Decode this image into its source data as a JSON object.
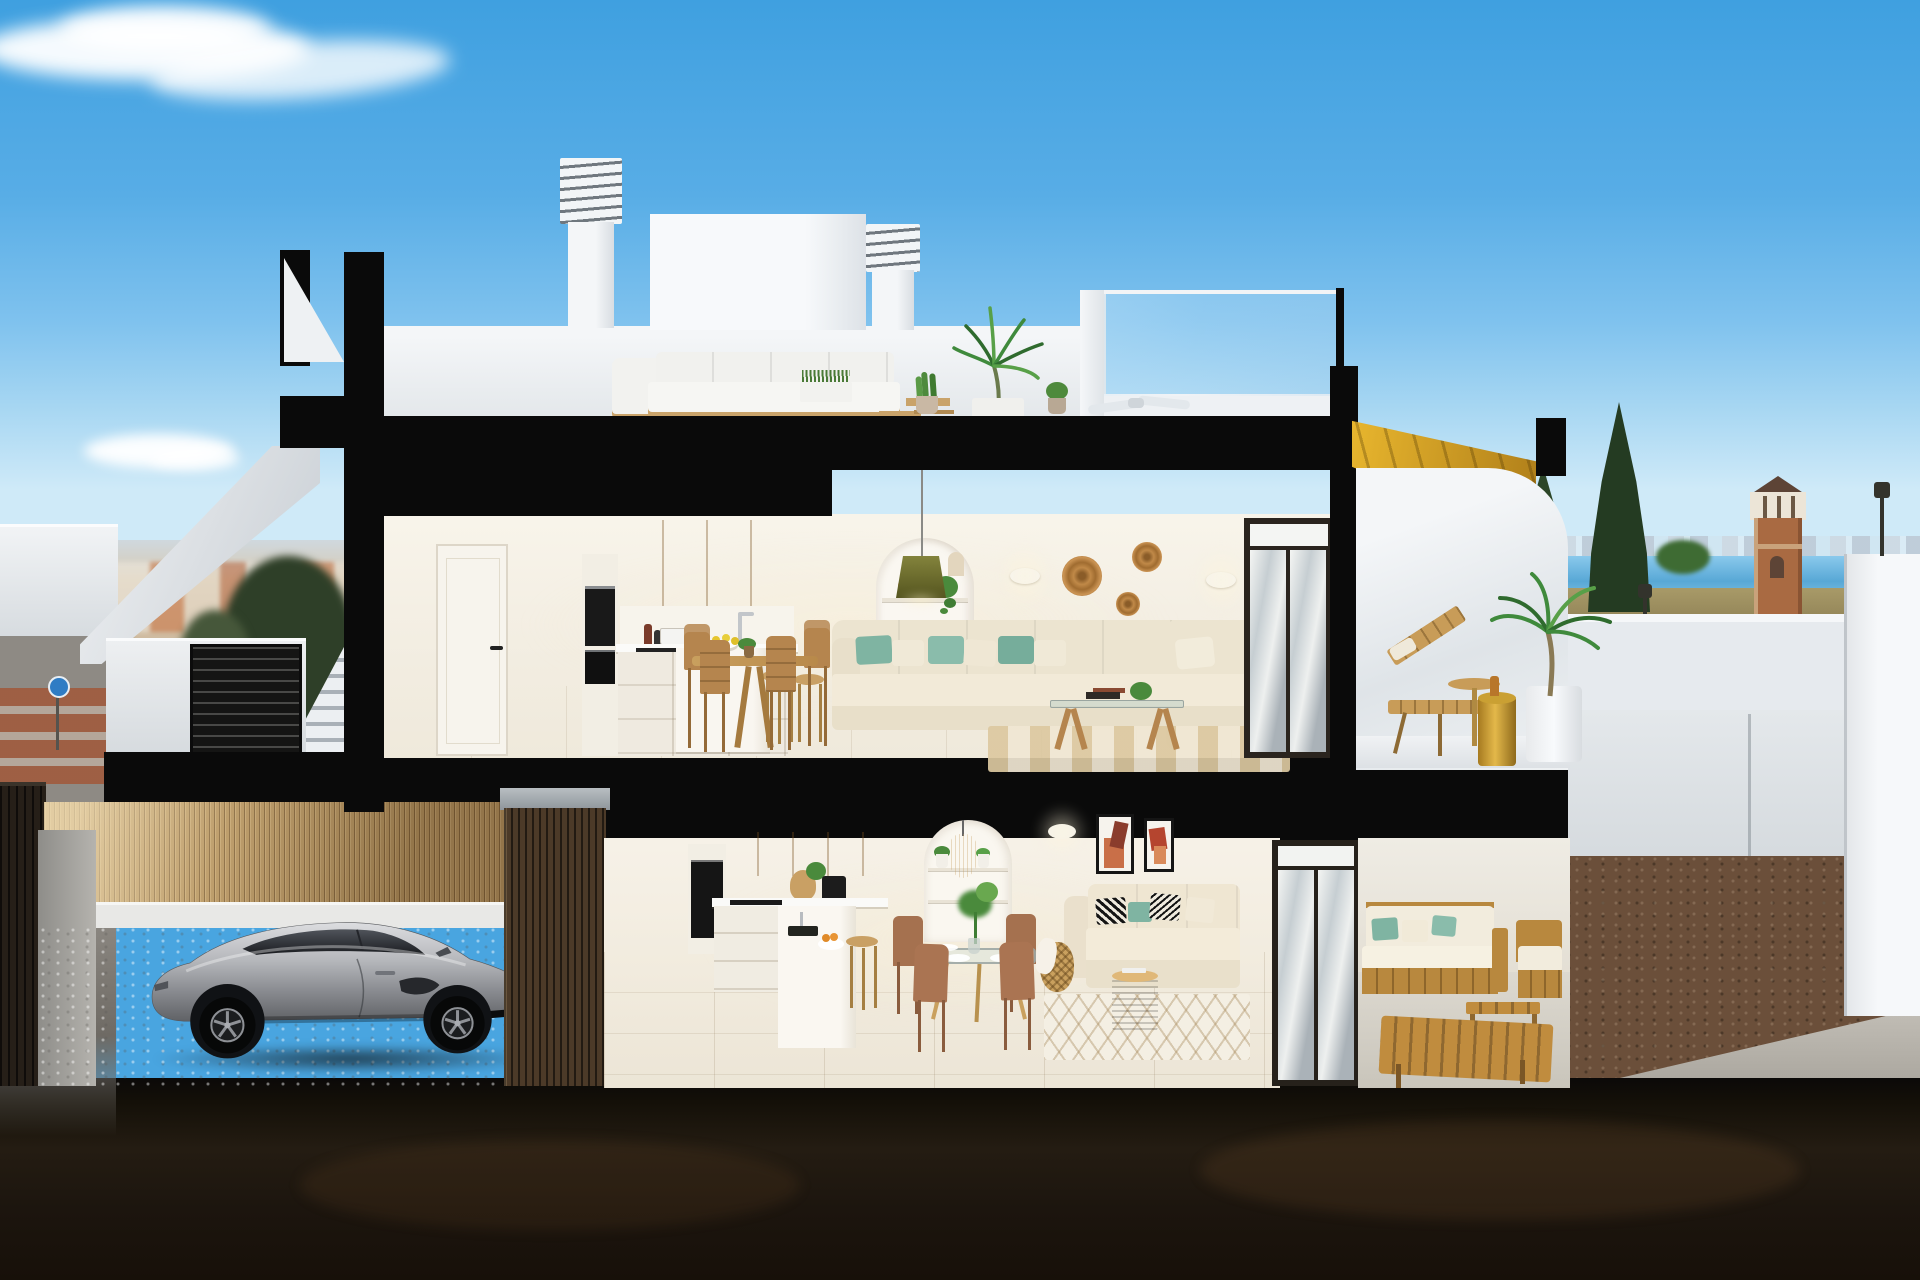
{
  "scene": {
    "type": "3d-architectural-cross-section-render",
    "subject": "Two-storey coastal townhouse cutaway with furnished interiors, rooftop terrace, garage and terraces",
    "time_of_day": "daytime, clear sky",
    "sky": {
      "color_top": "#3fa0e0",
      "color_horizon": "#cfeaf8",
      "clouds": [
        "large wispy cloud top-left",
        "small cloud above town on left"
      ]
    },
    "background": {
      "left": {
        "town": "low-rise town with terracotta roofs and white facades",
        "trees": "dense green street trees",
        "road": {
          "surface": "grey asphalt",
          "crosswalk_color": "#a05b3e",
          "sign": "blue circular traffic sign on pole"
        },
        "street_elements": [
          "white parapet wall",
          "white exterior staircase",
          "black louvered gate"
        ]
      },
      "right": {
        "sea_color": "#58a8d6",
        "skyline": "distant white coastal buildings on horizon",
        "watchtower": "brick lookout tower with white pillared loggia and dark pyramid roof",
        "conifer_trees": 2,
        "street_lamps": 3,
        "terrain": "dry olive scrubland",
        "garden": [
          "white rendered walls",
          "brown gravel bed",
          "concrete path"
        ]
      }
    },
    "building": {
      "section_cut_color": "#0a0a0a",
      "roof": {
        "chimneys": [
          {
            "name": "tall chimney",
            "cap": "louvered"
          },
          {
            "name": "short chimney",
            "cap": "louvered"
          }
        ],
        "stair_bulkhead": "white box volume",
        "terrace": {
          "furniture": [
            "white outdoor sofa",
            "white lounge chair",
            "grass planter box",
            "wood side tables",
            "potted aloe",
            "tall potted palm"
          ],
          "features": [
            "glass balustrade with black post",
            "white ceiling fan",
            "white parapet"
          ]
        }
      },
      "upper_floor": {
        "hallway": {
          "door": "white interior door, black handle"
        },
        "kitchen": {
          "upper_cabinets": "light oak",
          "appliances": [
            "stacked black wall ovens",
            "induction hob",
            "chrome faucet"
          ],
          "counter_items": [
            "white pot",
            "oil bottles"
          ],
          "island": "white block island with bowl of lemons",
          "stools": "2 wooden stools"
        },
        "dining": {
          "pendant_lamp": "olive green cone",
          "arched_niche": "white arch with 3 shelves, orange vases, trailing plant",
          "table": "round wood table",
          "chairs": "4 wooden chairs",
          "centerpiece": "green plant"
        },
        "living": {
          "sofa": "long cream sectional with chaise",
          "pillow_colors": [
            "#7fb4a2",
            "#f0e9d7"
          ],
          "coffee_table": "glass top, wood trestle legs, books and plant",
          "rug": "beige striped rug",
          "wall_decor": [
            "3 round woven baskets",
            "2 white wall sconces"
          ],
          "glass_slider": "dark-framed sliding glass door"
        },
        "terrace": {
          "stair_soffit": "golden wood cantilevered stair",
          "wall": "white curved parapet",
          "furniture": [
            "wooden slat sun lounger",
            "round tray table",
            "gold drum side table"
          ],
          "plant": "potted palm in white planter"
        }
      },
      "lower_floor": {
        "garage": {
          "car": {
            "type": "sports coupe",
            "color": "silver grey",
            "facing": "right"
          },
          "back_wall": "bamboo reed fence",
          "floor": "grey cobble pavers",
          "pillar": "dark timber slat pillar with concrete cap"
        },
        "kitchen": {
          "upper_cabinets": "light oak",
          "appliances": [
            "black wall oven",
            "black coffee machine",
            "induction hob"
          ],
          "peninsula": "white block with black sink and bowl of oranges",
          "stool": "1 wooden stool"
        },
        "dining": {
          "table": "round glass table with splayed wood legs",
          "chairs": "4 brown chairs",
          "place_settings": 4,
          "centerpiece": "green plant in glass vase"
        },
        "living": {
          "sofa": "cream sofa",
          "pillow_styles": [
            "black-white patterned",
            "teal",
            "cream"
          ],
          "art": "2 framed abstract prints in terracotta tones",
          "floor_lamp": "wicker basket lamp with draped throw",
          "rug": "white diamond-lattice rug",
          "coffee_table": "rattan drum table",
          "niche": "white arch shelf with rattan pendant and plants",
          "sconce": "white wall sconce"
        },
        "terrace": {
          "furniture": [
            "wood-frame sofa with white cushions and teal pillows",
            "wood armchair",
            "slatted wood lounger",
            "slatted wood coffee table"
          ]
        }
      },
      "ground": "dark earth section-cut band across bottom"
    },
    "palette": {
      "section_black": "#0a0a0a",
      "exterior_white": "#f2f3f5",
      "interior_cream": "#f4efe5",
      "oak_cabinet": "#d4a964",
      "floor_beige": "#e7dfcc",
      "teal_accent": "#7fb4a2",
      "basket_tan": "#c08948",
      "gold_stair": "#d9a625",
      "car_silver": "#9a9ca1",
      "bamboo": "#b5935f",
      "sea_blue": "#58a8d6",
      "roof_terracotta": "#c27948",
      "gravel_brown": "#6b4f3a"
    }
  }
}
